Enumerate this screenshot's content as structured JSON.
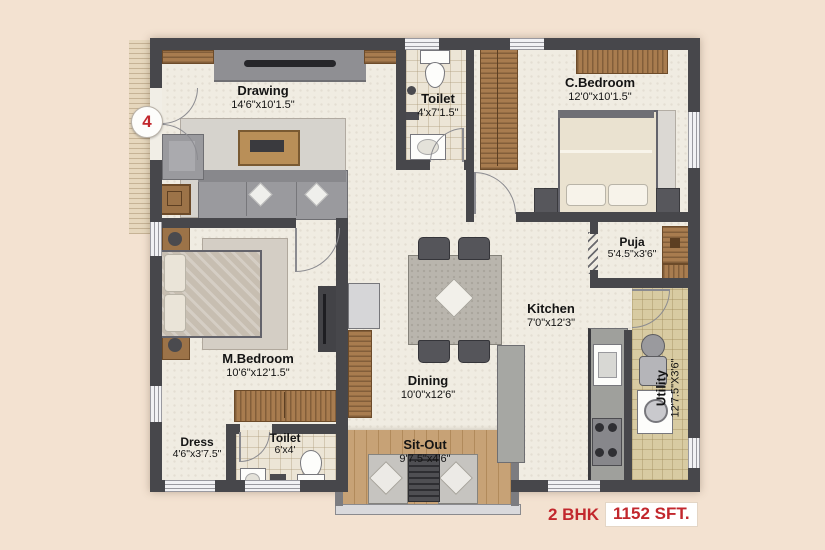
{
  "page": {
    "background": "#f3e2d1",
    "type": "apartment-floor-plan"
  },
  "marker": {
    "label": "4"
  },
  "rooms": {
    "drawing": {
      "name": "Drawing",
      "dims": "14'6\"x10'1.5\""
    },
    "toilet_top": {
      "name": "Toilet",
      "dims": "4'x7'1.5\""
    },
    "c_bedroom": {
      "name": "C.Bedroom",
      "dims": "12'0\"x10'1.5\""
    },
    "puja": {
      "name": "Puja",
      "dims": "5'4.5\"x3'6\""
    },
    "kitchen": {
      "name": "Kitchen",
      "dims": "7'0\"x12'3\""
    },
    "utility": {
      "name": "Utility",
      "dims": "12'7.5\"X3'6\""
    },
    "m_bedroom": {
      "name": "M.Bedroom",
      "dims": "10'6\"x12'1.5\""
    },
    "dining": {
      "name": "Dining",
      "dims": "10'0\"x12'6\""
    },
    "dress": {
      "name": "Dress",
      "dims": "4'6\"x3'7.5\""
    },
    "toilet_bottom": {
      "name": "Toilet",
      "dims": "6'x4'"
    },
    "sit_out": {
      "name": "Sit-Out",
      "dims": "9'7.5\"x4'6\""
    }
  },
  "footer": {
    "bhk": "2 BHK",
    "area": "1152 SFT."
  },
  "colors": {
    "accent_red": "#c2272d",
    "wall": "#47474b",
    "wood": "#a87c4f",
    "floor": "#f0ece2",
    "deck": "#c7a276",
    "utility_floor": "#d8cba2",
    "background": "#f3e2d1"
  }
}
